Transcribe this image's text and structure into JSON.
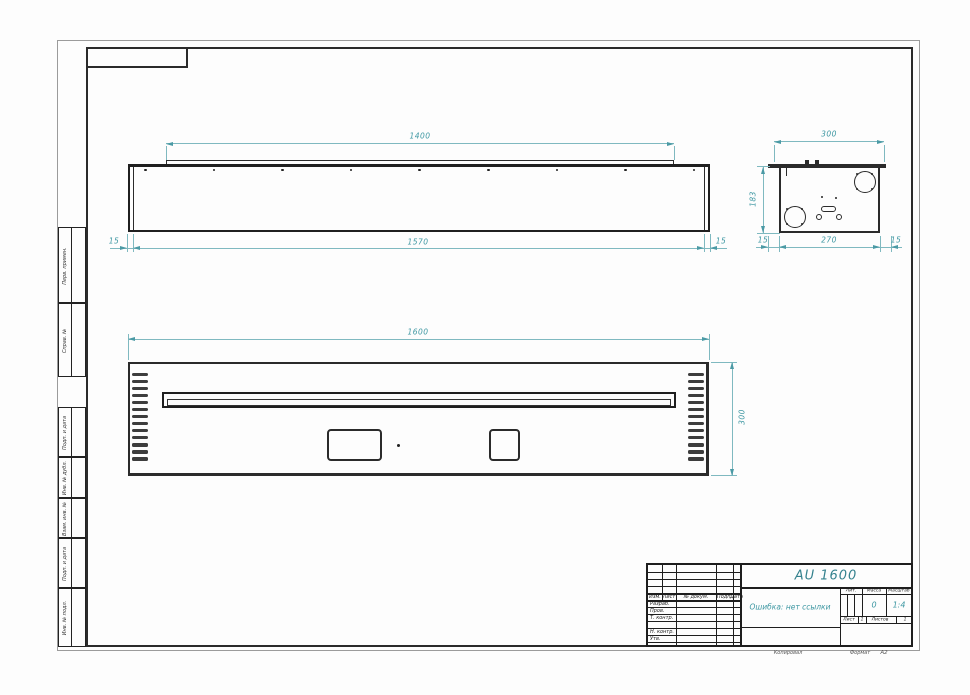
{
  "colors": {
    "dimension_teal": "#3d97a2",
    "drawing_line": "#2b2b2b",
    "outer_border_gray": "#9b9b9b"
  },
  "top_view": {
    "dim_flange": "1400",
    "dim_overall": "1570",
    "dim_left_offset": "15",
    "dim_right_offset": "15",
    "hole_count": 9
  },
  "side_view": {
    "dim_width": "300",
    "dim_height": "183",
    "dim_inner": "270",
    "dim_left_offset": "15",
    "dim_right_offset": "15"
  },
  "front_view": {
    "dim_width": "1600",
    "dim_height": "300",
    "louver_count": 13
  },
  "strips": [
    {
      "label": "Перв. примен."
    },
    {
      "label": "Справ. №"
    },
    {
      "label": "Подп. и дата"
    },
    {
      "label": "Инв. № дубл."
    },
    {
      "label": "Взам. инв. №"
    },
    {
      "label": "Подп. и дата"
    },
    {
      "label": "Инв. № подл."
    }
  ],
  "title_block": {
    "designation": "AU 1600",
    "doc_name": "Ошибка: нет ссылки",
    "header_cols": [
      "Изм.",
      "Лист",
      "№ докум.",
      "Подп.",
      "Дата"
    ],
    "row_labels": [
      "Разраб.",
      "Пров.",
      "Т. контр.",
      "",
      "Н. контр.",
      "Утв."
    ],
    "lit_label": "Лит.",
    "mass_label": "Масса",
    "mass_value": "0",
    "scale_label": "Масштаб",
    "scale_value": "1:4",
    "sheet_label": "Лист",
    "sheet_value": "1",
    "sheets_label": "Листов",
    "sheets_value": "1",
    "copied_label": "Копировал",
    "format_label": "Формат",
    "format_value": "А2"
  }
}
